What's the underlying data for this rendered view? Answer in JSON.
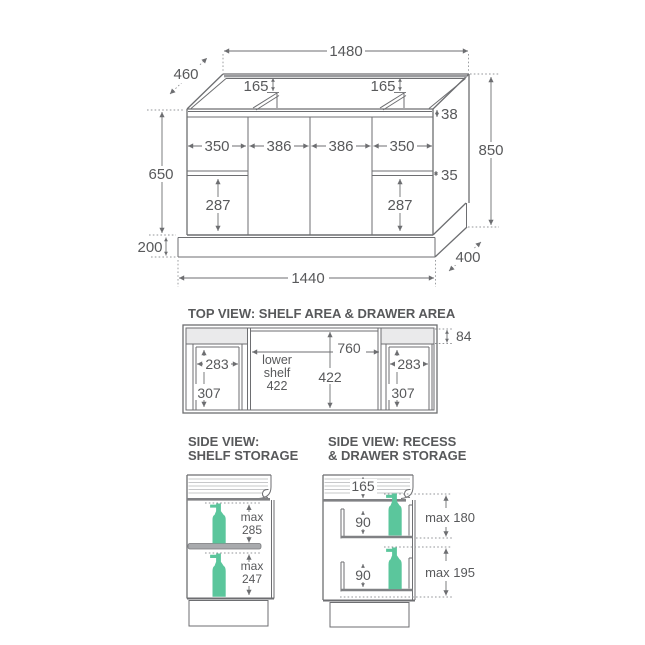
{
  "colors": {
    "line": "#6d6e71",
    "text": "#58595b",
    "bottle_green": "#5bc69c",
    "recess_band": "#eaeaeb",
    "shelf_gray": "#a8aaad"
  },
  "iso": {
    "width_top": "1480",
    "depth_top": "460",
    "recess_left": "165",
    "recess_right": "165",
    "top_rail": "38",
    "panel_widths": [
      "350",
      "386",
      "386",
      "350"
    ],
    "cabinet_height": "650",
    "drawer_gap": "35",
    "drawer_left": "287",
    "drawer_right": "287",
    "overall_height": "850",
    "kick_height": "200",
    "base_width": "1440",
    "base_depth": "400"
  },
  "top_view": {
    "title": "TOP VIEW: SHELF AREA & DRAWER AREA",
    "center_width": "760",
    "recess_depth": "84",
    "left_width": "283",
    "left_depth": "307",
    "right_width": "283",
    "right_depth": "307",
    "center_depth": "422",
    "shelf_label_line1": "lower",
    "shelf_label_line2": "shelf",
    "shelf_label_line3": "422"
  },
  "side_shelf": {
    "title_line1": "SIDE VIEW:",
    "title_line2": "SHELF STORAGE",
    "upper_word": "max",
    "upper_value": "285",
    "lower_word": "max",
    "lower_value": "247"
  },
  "side_drawer": {
    "title_line1": "SIDE VIEW: RECESS",
    "title_line2": "& DRAWER STORAGE",
    "recess_depth": "165",
    "upper_drawer": "90",
    "lower_drawer": "90",
    "upper_max": "max 180",
    "lower_max": "max 195"
  }
}
